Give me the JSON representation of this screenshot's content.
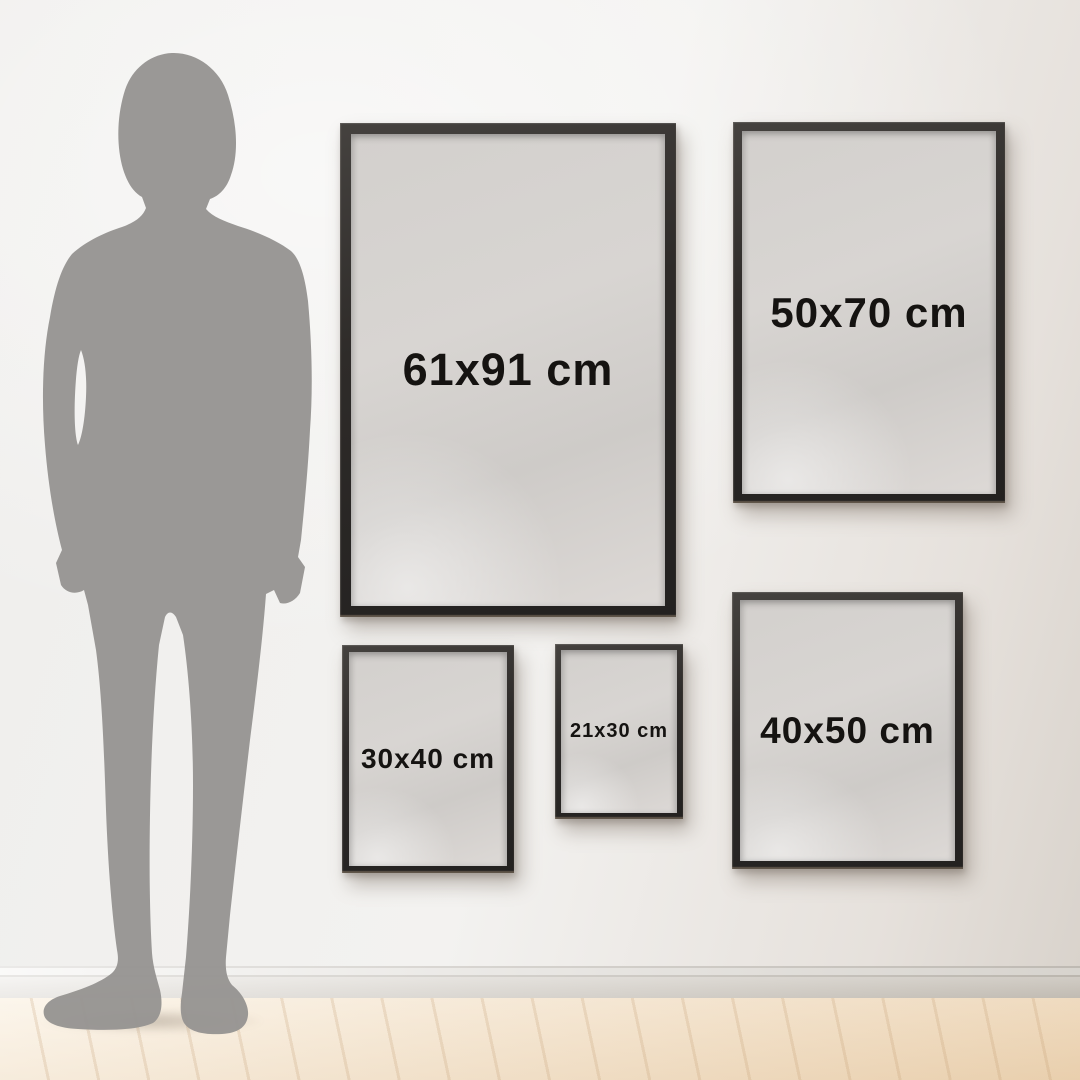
{
  "frames": [
    {
      "id": "61x91",
      "label": "61x91 cm"
    },
    {
      "id": "50x70",
      "label": "50x70 cm"
    },
    {
      "id": "30x40",
      "label": "30x40 cm"
    },
    {
      "id": "21x30",
      "label": "21x30 cm"
    },
    {
      "id": "40x50",
      "label": "40x50 cm"
    }
  ],
  "figure": {
    "icon": "human-silhouette-icon"
  },
  "colors": {
    "frame_border": "#2e2b29",
    "frame_mat": "#d5d2cf",
    "label_text": "#151311",
    "silhouette": "#969492",
    "wall": "#f2f1ef",
    "wall_shadow_side": "#d9d3cc",
    "baseboard": "#eae8e4",
    "floor": "#f7ead6"
  }
}
